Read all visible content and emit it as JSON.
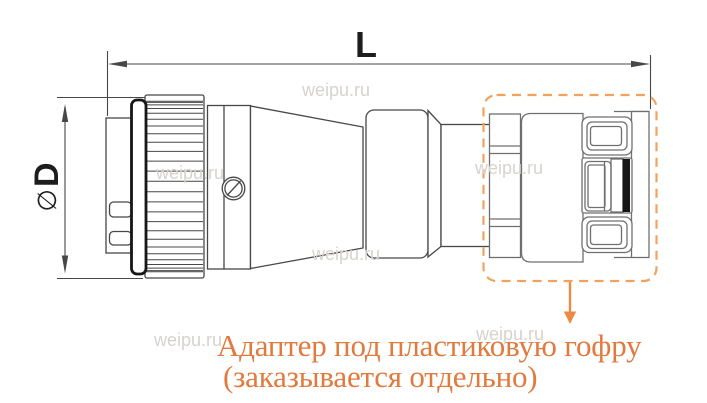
{
  "diagram": {
    "length_label": "L",
    "diameter_symbol": "∅",
    "diameter_letter": "D"
  },
  "annotation": {
    "line1": "Адаптер под пластиковую гофру",
    "line2": "(заказывается отдельно)"
  },
  "watermark": "weipu.ru",
  "colors": {
    "line": "#474747",
    "line_light": "#6f6f6f",
    "black": "#161616",
    "orange_text": "#e2793d",
    "orange_dash": "#f2a25d",
    "orange_arrow": "#ec8b43",
    "watermark": "#d6d3cf",
    "background": "#ffffff"
  }
}
